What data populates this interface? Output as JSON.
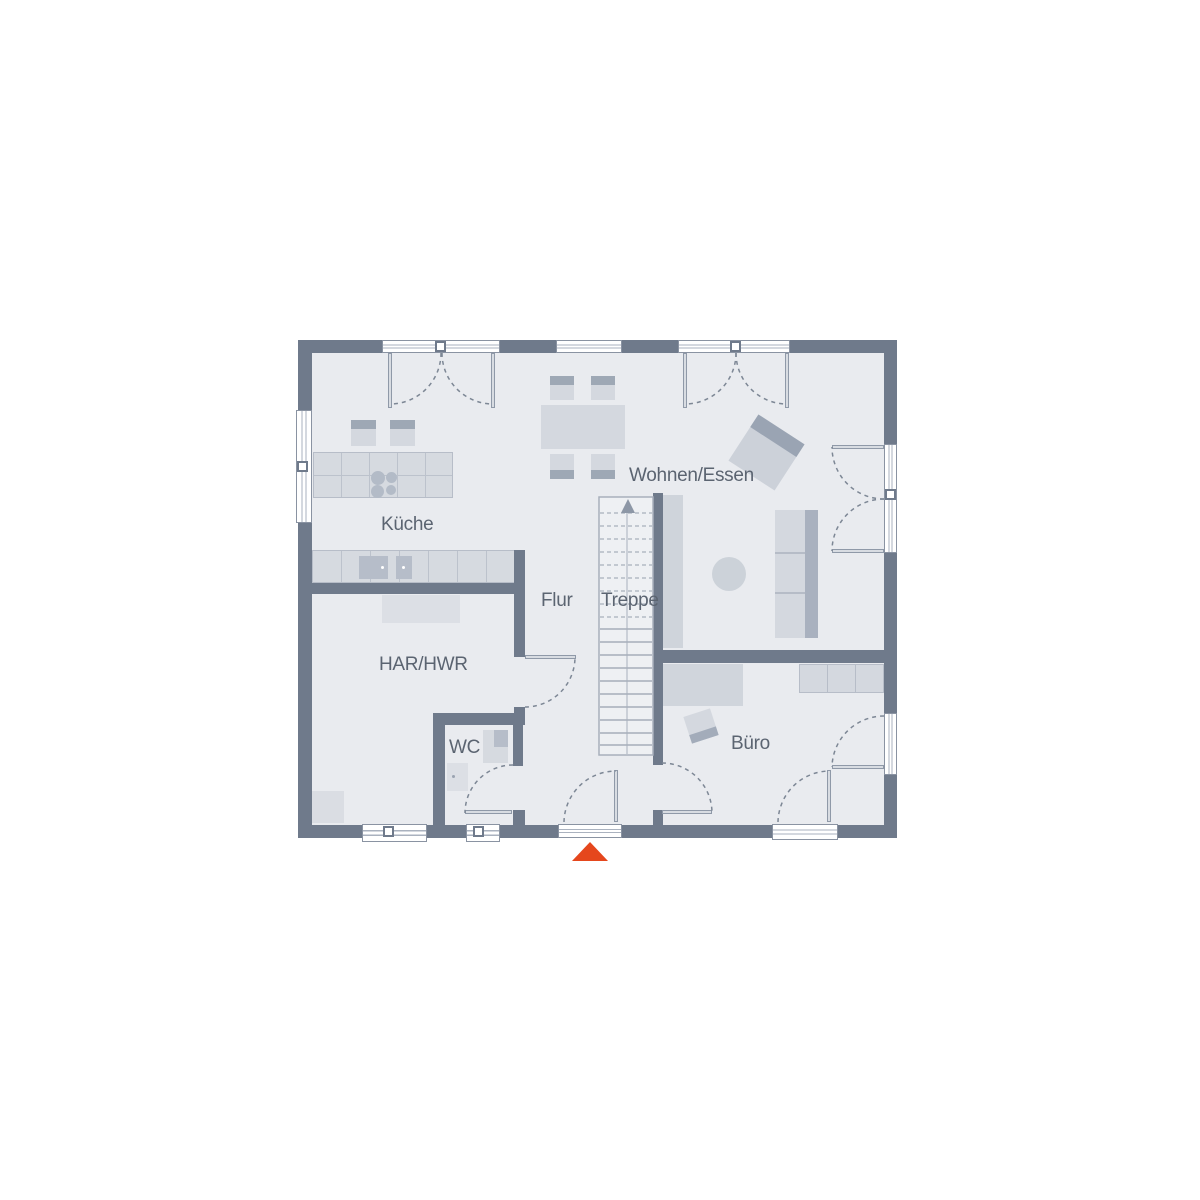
{
  "plan": {
    "title": "floor-plan-ground-floor",
    "rooms": [
      {
        "id": "kueche",
        "label": "Küche"
      },
      {
        "id": "wohnen-essen",
        "label": "Wohnen/Essen"
      },
      {
        "id": "flur",
        "label": "Flur"
      },
      {
        "id": "treppe",
        "label": "Treppe"
      },
      {
        "id": "har-hwr",
        "label": "HAR/HWR"
      },
      {
        "id": "wc",
        "label": "WC"
      },
      {
        "id": "buero",
        "label": "Büro"
      }
    ],
    "colors": {
      "wall": "#6F7A8B",
      "floor": "#E9EBEF",
      "furniture_light": "#D4D8DF",
      "furniture_band": "#9EA8B5",
      "stair_lines": "#A8B0BC",
      "door_arc": "#7D8795",
      "text": "#5B6471",
      "entrance_marker": "#E5471D",
      "background": "#FFFFFF"
    },
    "entrance_marker": "triangle-up",
    "stair_direction": "up"
  }
}
